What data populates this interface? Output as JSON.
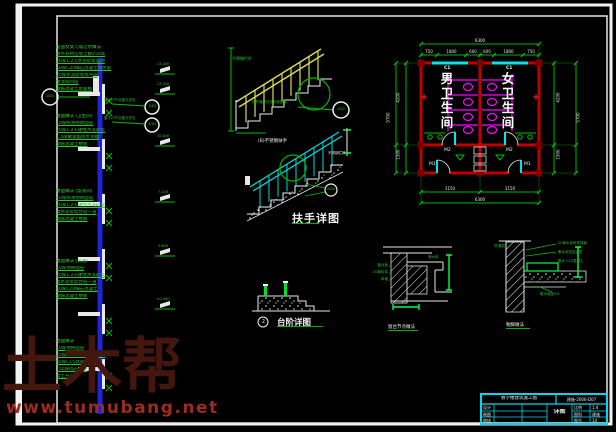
{
  "watermark": {
    "brand": "土木帮",
    "url": "www.tumubang.net"
  },
  "left_section": {
    "stacks": [
      {
        "header": "屋面及女儿墙泛水做法",
        "lines": [
          "防水卷材沿墙上翻250高",
          "20厚1:2.5水泥砂浆压顶",
          "40厚C20细石混凝土防水层",
          "20厚水泥砂浆找平层",
          "保温隔热层",
          "钢筋混凝土屋面板"
        ]
      },
      {
        "header": "楼面做法 (卫生间)",
        "lines": [
          "10厚防滑地砖面层",
          "20厚1:2干硬性水泥砂浆",
          "1.5厚聚氨酯防水涂膜",
          "钢筋混凝土楼板"
        ]
      },
      {
        "header": "楼面做法 (盥洗间)",
        "lines": [
          "10厚防滑地砖面层",
          "20厚1:2干硬性水泥砂浆",
          "素水泥浆结合层一道",
          "钢筋混凝土楼板"
        ]
      },
      {
        "header": "楼面做法 (普通)",
        "lines": [
          "10厚地砖面层",
          "20厚1:2干硬性水泥砂浆",
          "素水泥浆结合层一道",
          "40厚C20细石混凝土",
          "钢筋混凝土楼板"
        ]
      },
      {
        "header": "地面做法",
        "lines": [
          "10厚地砖面层",
          "20厚1:2干硬性水泥砂浆",
          "60厚C15混凝土垫层",
          "150厚碎石垫层",
          "素土夯实"
        ]
      }
    ],
    "levels": [
      "14.400",
      "13.200",
      "10.800",
      "7.200",
      "3.600",
      "±0.000"
    ],
    "callout_left_ref": "1/D1",
    "callouts_mid": [
      {
        "label": "窗上口节点做法详见",
        "ref": "3/D1"
      },
      {
        "label": "窗下口节点做法详见",
        "ref": "4/D1"
      }
    ]
  },
  "stair_yellow": {
    "note_top": "不锈钢栏杆",
    "leader_note": "栏杆做法详见标准图集",
    "bubble_ref": "1/D2"
  },
  "stair_cyan": {
    "label": "(B)不锈钢扶手",
    "side_note": "不锈钢栏杆",
    "bubble_ref": "2/D2"
  },
  "handrail_title": "扶手详图",
  "toilet_plan": {
    "room_left": "男卫生间",
    "room_right": "女卫生间",
    "tag_window_left": "C1",
    "tag_window_right": "C1",
    "tag_door_left": "M1",
    "tag_door_right": "M1",
    "tag_door_inner_left": "M2",
    "tag_door_inner_right": "M2",
    "dims": {
      "top_total": "6300",
      "top_segments": [
        "750",
        "1800",
        "600",
        "600",
        "1800",
        "750"
      ],
      "bottom_segments": [
        "3150",
        "3150"
      ],
      "bottom_total": "6300",
      "left_segments": [
        "4200",
        "1500"
      ],
      "left_total": "5700",
      "right_segments": [
        "4200",
        "1500"
      ],
      "right_total": "5700"
    }
  },
  "steps_detail": {
    "bubble": "2",
    "title": "台阶详图"
  },
  "detail_a": {
    "notes_left": [
      "窗台板",
      "20厚砂浆",
      "砖墙"
    ],
    "note_right": "滴水线",
    "caption": "窗台节点做法"
  },
  "detail_b": {
    "note_left": "防潮层",
    "notes_right": [
      "20厚水泥砂浆抹面",
      "素水泥浆结合层",
      "散水 C15混凝土"
    ],
    "note_bottom": "散水坡度3%",
    "caption": "勒脚做法"
  },
  "title_block": {
    "project": "教学楼建筑施工图",
    "code": "建施-2006-D07",
    "left_rows": [
      "设计",
      "制图",
      "审核"
    ],
    "right_rows": [
      {
        "label": "比例",
        "value": "1:4"
      },
      {
        "label": "图别",
        "value": "建施"
      },
      {
        "label": "图号",
        "value": "14"
      }
    ],
    "center": "详图"
  }
}
